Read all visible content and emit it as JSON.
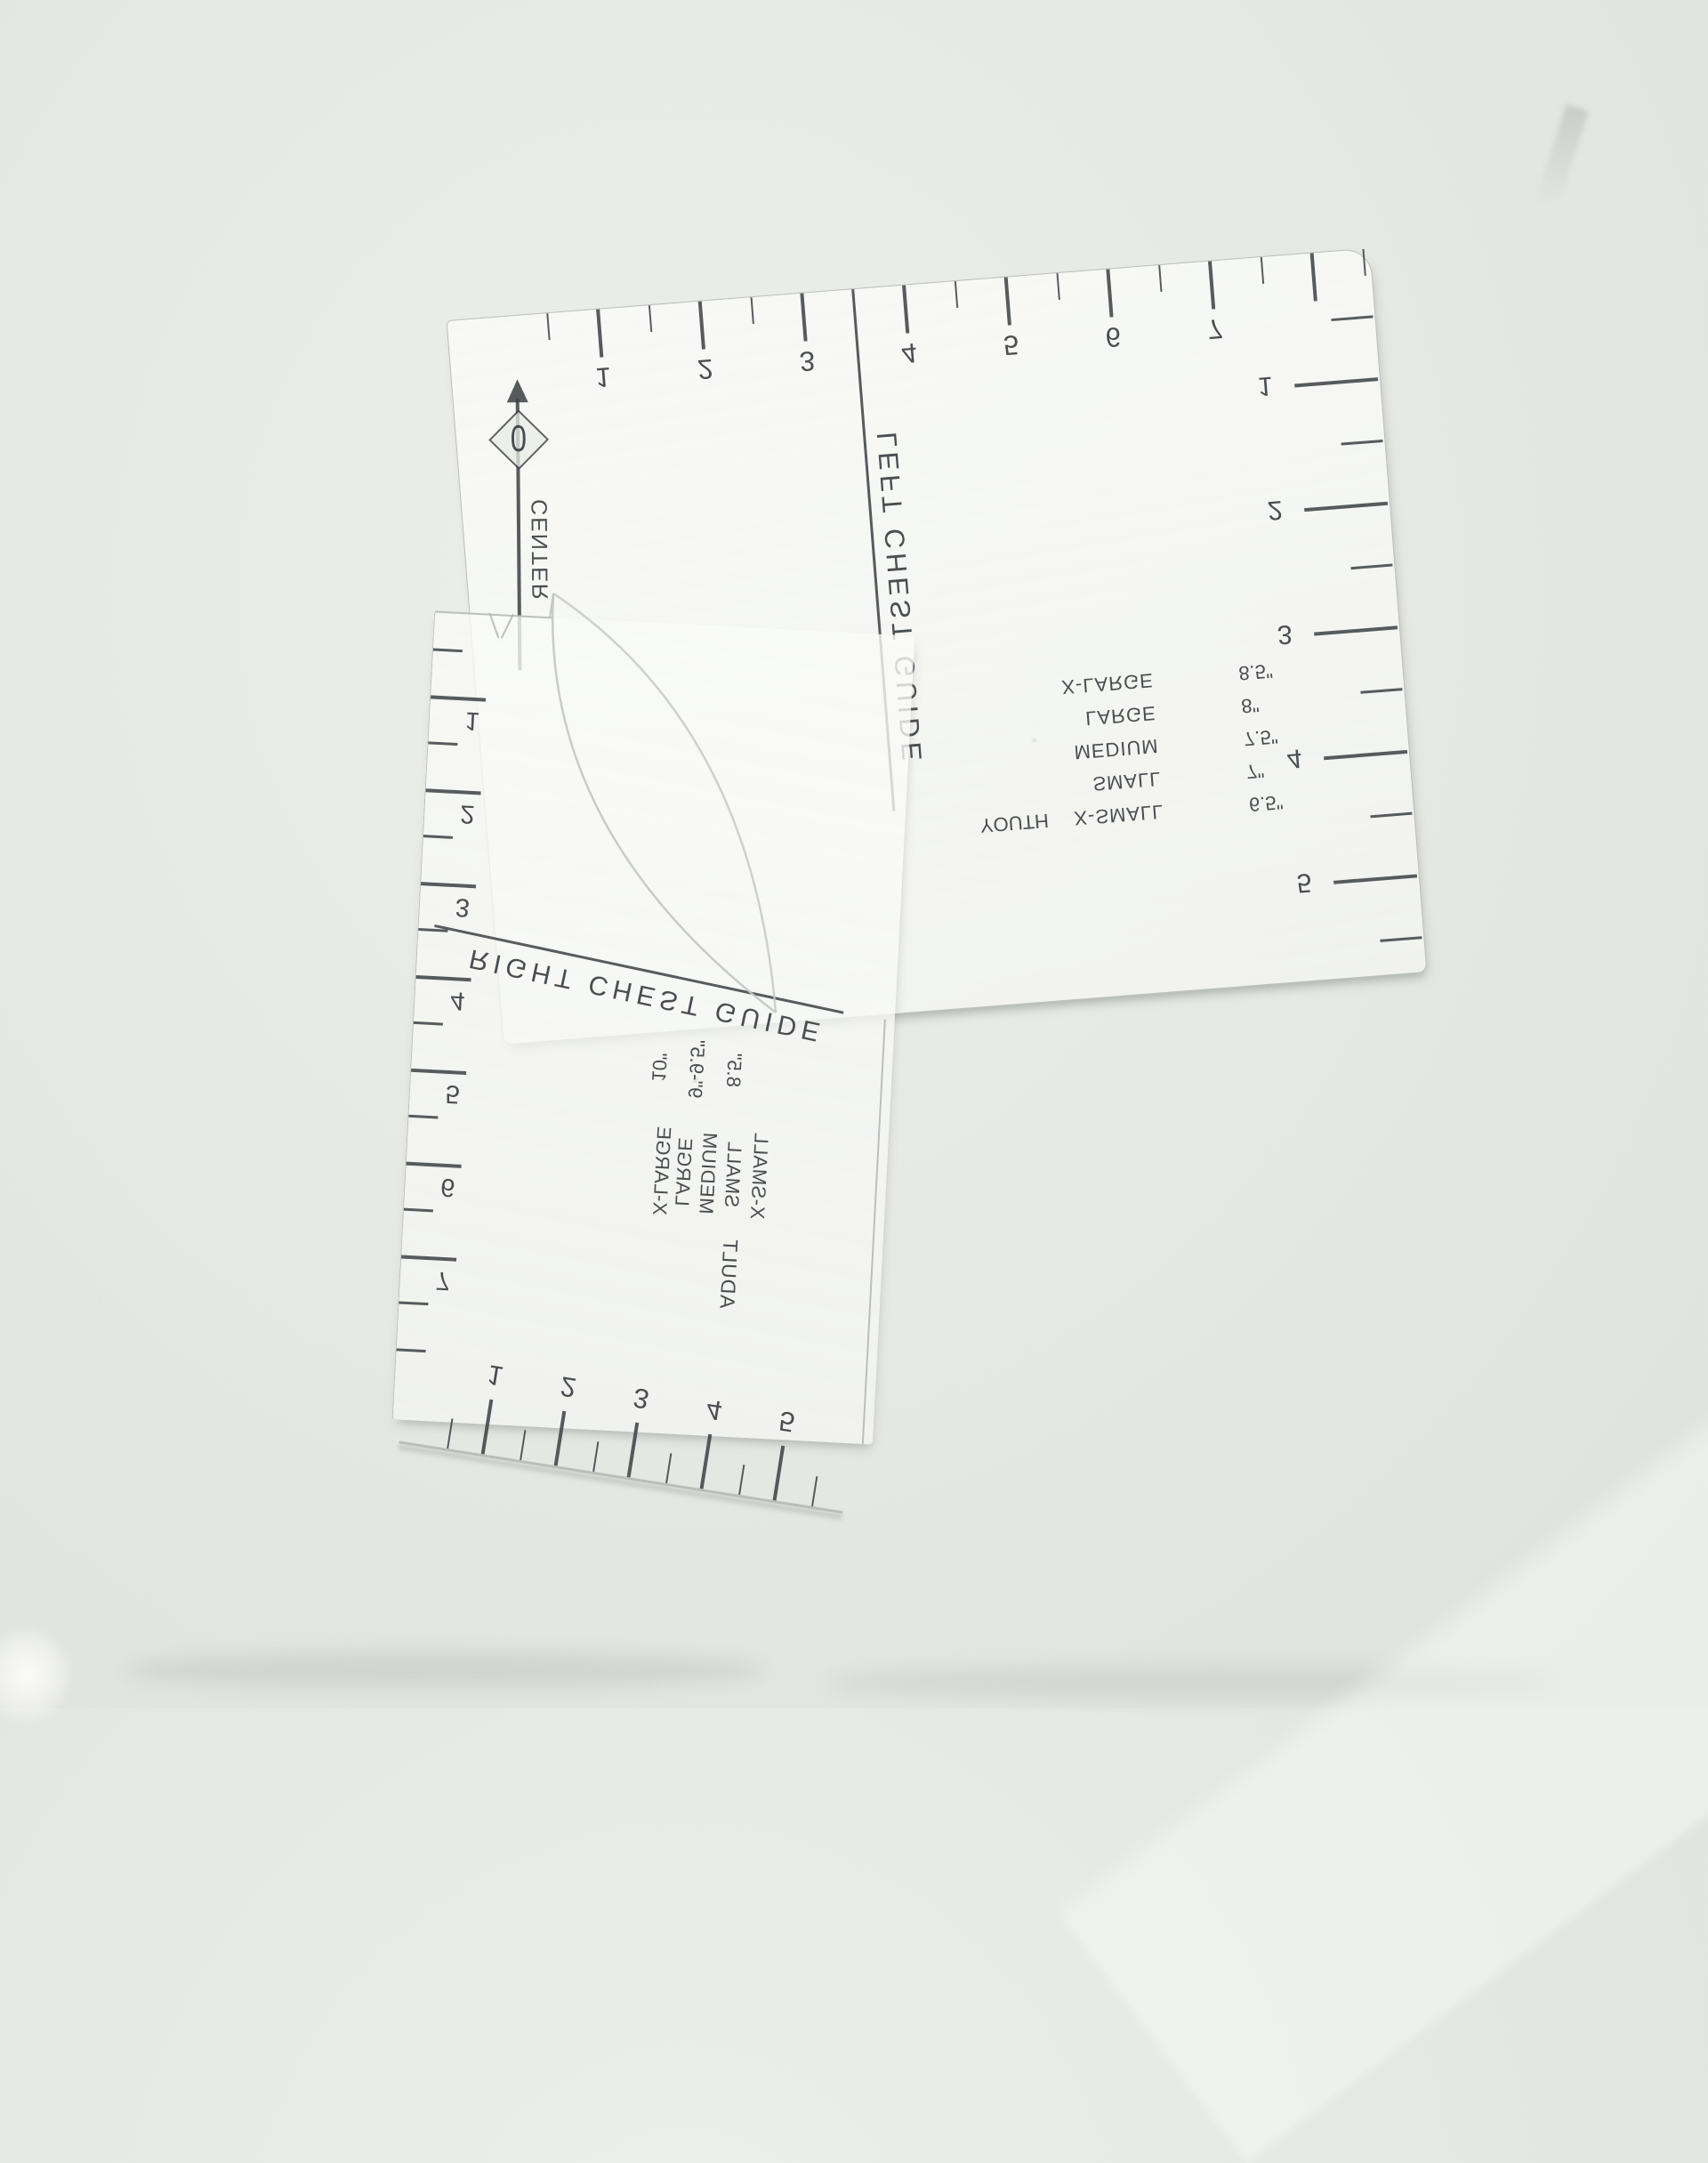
{
  "photo": {
    "description": "Two transparent acrylic T-shirt alignment ruler guides lying face-down on a light gray surface; printed markings show through mirrored and upside-down",
    "background_color": "#e7e9e5",
    "ink_color": "#3c4043"
  },
  "left_chest_guide": {
    "title_vertical": "LEFT CHEST GUIDE",
    "center_line_label": "CENTER",
    "origin_label": "0",
    "top_scale_numbers": [
      "1",
      "2",
      "3",
      "4",
      "5",
      "6",
      "7"
    ],
    "right_scale_numbers": [
      "1",
      "2",
      "3",
      "4",
      "5"
    ],
    "size_table": {
      "rows": [
        {
          "group": "",
          "size": "X-LARGE",
          "value": "8.5\""
        },
        {
          "group": "",
          "size": "LARGE",
          "value": "8\""
        },
        {
          "group": "",
          "size": "MEDIUM",
          "value": "7.5\""
        },
        {
          "group": "",
          "size": "SMALL",
          "value": "7\""
        },
        {
          "group": "YOUTH",
          "size": "X-SMALL",
          "value": "6.5\""
        }
      ]
    }
  },
  "right_chest_guide": {
    "title": "RIGHT CHEST GUIDE",
    "left_scale_numbers": [
      "1",
      "2",
      "3",
      "4",
      "5",
      "6",
      "7"
    ],
    "bottom_scale_numbers": [
      "1",
      "2",
      "3",
      "4",
      "5"
    ],
    "size_table": {
      "group_label": "ADULT",
      "sizes": [
        "X-LARGE",
        "LARGE",
        "MEDIUM",
        "SMALL",
        "X-SMALL"
      ],
      "values": [
        "10\"",
        "9\"-9.5\"",
        "8.5\""
      ]
    }
  }
}
